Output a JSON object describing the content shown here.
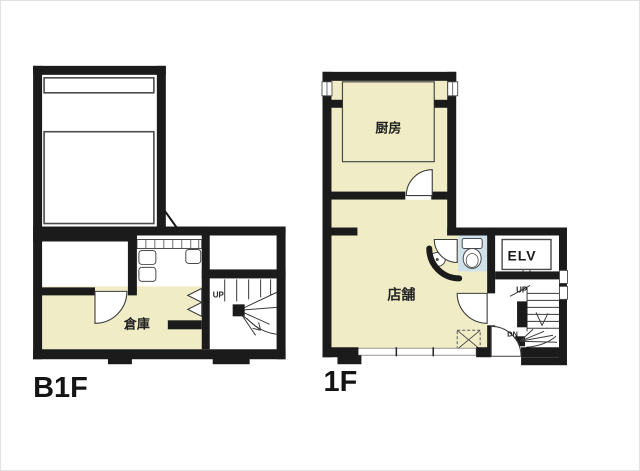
{
  "colors": {
    "wall": "#1b1b1b",
    "room_cream": "#f0edc6",
    "toilet_blue": "#cfe2ec",
    "background": "#ffffff"
  },
  "plans": {
    "b1f": {
      "floor_label": "B1F",
      "storage_label": "倉庫",
      "stair_up_label": "UP"
    },
    "first_floor": {
      "floor_label": "1F",
      "kitchen_label": "厨房",
      "shop_label": "店舗",
      "elevator_label": "ELV",
      "stair_up_label": "UP",
      "stair_down_label": "DN"
    }
  }
}
